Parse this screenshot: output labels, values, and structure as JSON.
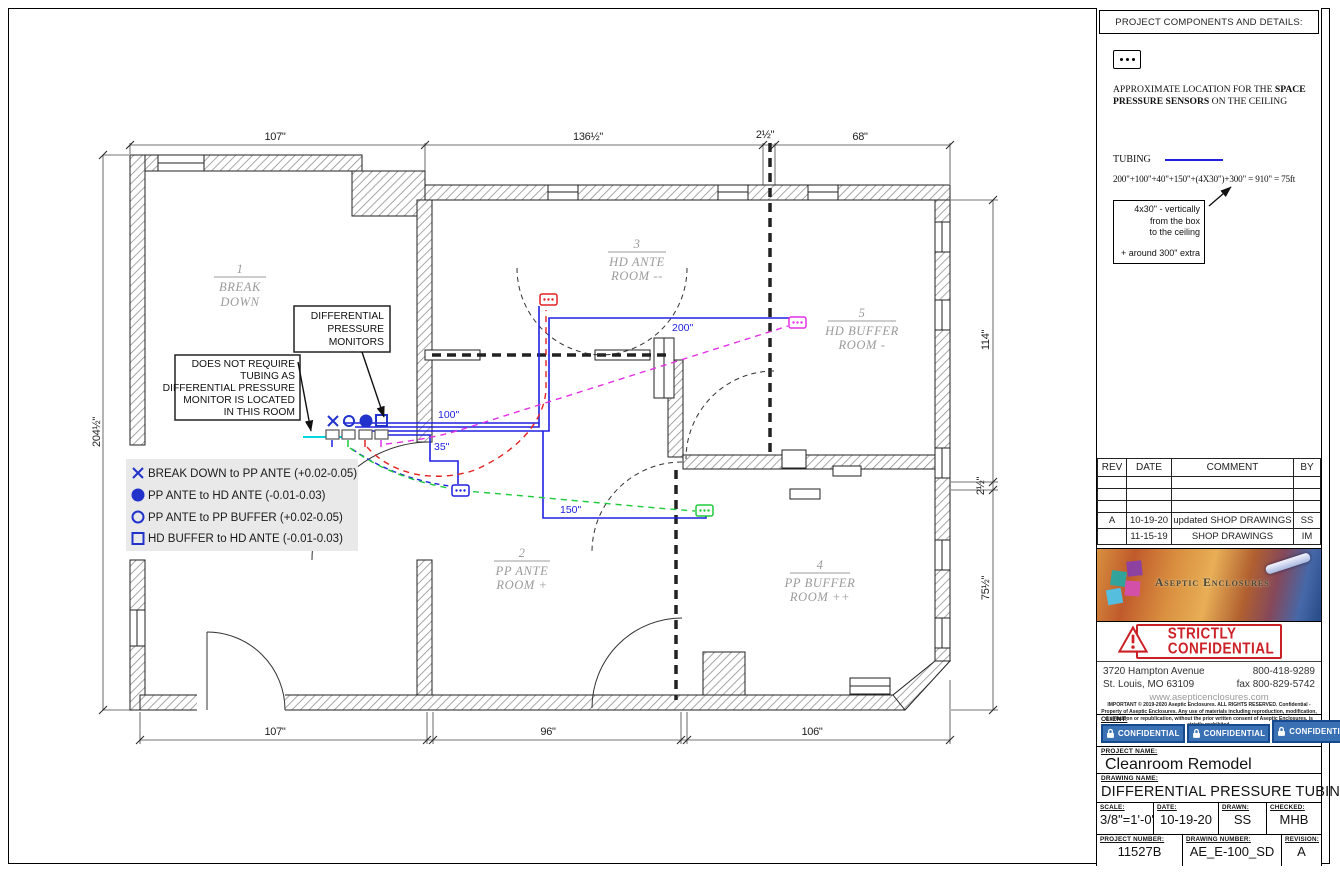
{
  "plan": {
    "dimensions": {
      "top": [
        "107\"",
        "136½\"",
        "2½\"",
        "68\""
      ],
      "bottom": [
        "107\"",
        "96\"",
        "106\""
      ],
      "left": "204½\"",
      "right": [
        "114\"",
        "2½\"",
        "75½\""
      ]
    },
    "tubing_labels": {
      "l200": "200\"",
      "l100": "100\"",
      "l35": "35\"",
      "l150": "150\""
    },
    "rooms": [
      {
        "num": "1",
        "line1": "BREAK",
        "line2": "DOWN"
      },
      {
        "num": "2",
        "line1": "PP ANTE",
        "line2": "ROOM +"
      },
      {
        "num": "3",
        "line1": "HD ANTE",
        "line2": "ROOM --"
      },
      {
        "num": "4",
        "line1": "PP BUFFER",
        "line2": "ROOM ++"
      },
      {
        "num": "5",
        "line1": "HD BUFFER",
        "line2": "ROOM -"
      }
    ],
    "legend": [
      {
        "symbol": "x-mark",
        "label": "BREAK DOWN to PP ANTE (+0.02-0.05)"
      },
      {
        "symbol": "filled-circle",
        "label": "PP ANTE to HD ANTE (-0.01-0.03)"
      },
      {
        "symbol": "open-circle",
        "label": "PP ANTE to PP BUFFER (+0.02-0.05)"
      },
      {
        "symbol": "open-square",
        "label": "HD BUFFER to HD ANTE (-0.01-0.03)"
      }
    ],
    "callout_monitors": [
      "DIFFERENTIAL",
      "PRESSURE",
      "MONITORS"
    ],
    "callout_no_tubing": [
      "DOES NOT REQUIRE",
      "TUBING AS",
      "DIFFERENTIAL PRESSURE",
      "MONITOR IS LOCATED",
      "IN THIS ROOM"
    ]
  },
  "panel": {
    "header": "PROJECT COMPONENTS AND DETAILS:",
    "sensor_note": {
      "pre": "APPROXIMATE LOCATION FOR THE ",
      "bold": "SPACE PRESSURE SENSORS",
      "post": " ON THE CEILING"
    },
    "tubing_label": "TUBING",
    "formula": "200\"+100\"+40\"+150\"+(4X30\")+300\"  =  910\"  =  75ft",
    "callout": {
      "lines": [
        "4x30\" - vertically",
        "from the box",
        "to the ceiling"
      ],
      "extra": "+ around 300\" extra"
    },
    "revisions": {
      "headers": [
        "REV",
        "DATE",
        "COMMENT",
        "BY"
      ],
      "rows": [
        {
          "rev": "A",
          "date": "10-19-20",
          "comment": "updated SHOP DRAWINGS",
          "by": "SS"
        },
        {
          "rev": "",
          "date": "11-15-19",
          "comment": "SHOP DRAWINGS",
          "by": "IM"
        }
      ]
    },
    "logo_text": "Aseptic Enclosures",
    "confidential_stamp": {
      "line1": "STRICTLY",
      "line2": "CONFIDENTIAL"
    },
    "address": {
      "street": "3720 Hampton Avenue",
      "city": "St. Louis, MO 63109",
      "phone": "800-418-9289",
      "fax": "fax 800-829-5742",
      "web": "www.asepticenclosures.com"
    },
    "fine_print": "IMPORTANT © 2019-2020 Aseptic Enclosures. ALL RIGHTS RESERVED. Confidential - Property of Aseptic Enclosures. Any use of materials including reproduction, modification, distribution or republication, without the prior written consent of Aseptic Enclosures, is strictly prohibited.",
    "client": {
      "label": "CLIENT:",
      "badge": "CONFIDENTIAL",
      "suffix": "pital"
    },
    "project_name": {
      "label": "PROJECT NAME:",
      "value": "Cleanroom Remodel"
    },
    "drawing_name": {
      "label": "DRAWING NAME:",
      "value": "DIFFERENTIAL PRESSURE TUBING"
    },
    "meta": {
      "scale_label": "SCALE:",
      "scale": "3/8\"=1'-0\"",
      "date_label": "DATE:",
      "date": "10-19-20",
      "drawn_label": "DRAWN:",
      "drawn": "SS",
      "checked_label": "CHECKED:",
      "checked": "MHB",
      "project_number_label": "PROJECT NUMBER:",
      "project_number": "11527B",
      "drawing_number_label": "DRAWING NUMBER:",
      "drawing_number": "AE_E-100_SD",
      "revision_label": "REVISION:",
      "revision": "A"
    },
    "paper_note": "PAPER 17\"x11\""
  }
}
